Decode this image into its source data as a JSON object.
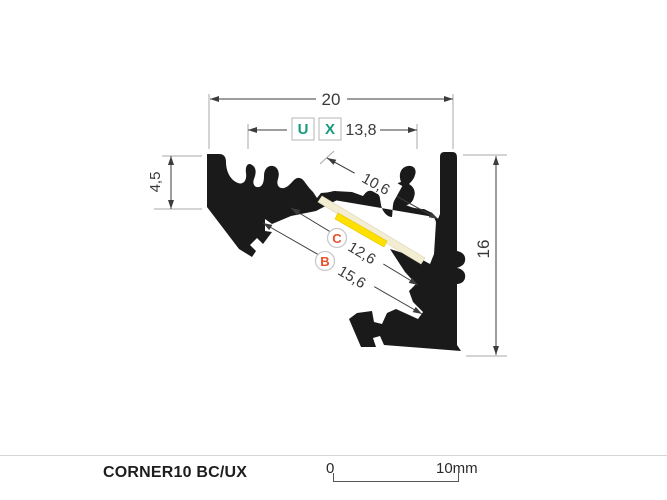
{
  "drawing": {
    "dim_total_width": "20",
    "dim_inner_width": "13,8",
    "dim_left_height": "4,5",
    "dim_total_height": "16",
    "dim_slot_width": "10,6",
    "dim_c_value": "12,6",
    "dim_b_value": "15,6",
    "marker_u": "U",
    "marker_x": "X",
    "marker_c": "C",
    "marker_b": "B"
  },
  "footer": {
    "product_name": "CORNER10 BC/UX",
    "scale_start": "0",
    "scale_end": "10mm"
  },
  "colors": {
    "profile_black": "#1a1a1a",
    "accent_green": "#169a7d",
    "accent_orange": "#e8502a",
    "led_yellow": "#ffe000",
    "diffuser_cream": "#f2edd3",
    "dim_line": "#3c3c3c",
    "ext_line": "#a8a8a8"
  }
}
